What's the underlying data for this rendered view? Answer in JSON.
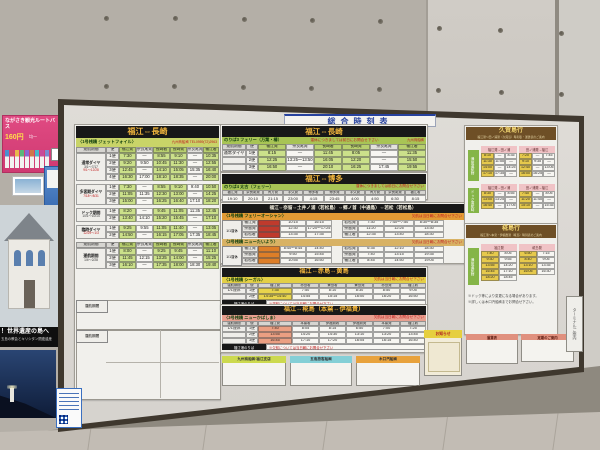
{
  "title_strip": "総合時刻表",
  "left_wall": {
    "bus_poster": {
      "title": "ながさき観光ルートバス",
      "price": "160円",
      "note": "均一"
    },
    "heritage_poster": {
      "band": "！世界遺産の島へ",
      "sub": "五島の教会とキリシタン関連遺産"
    }
  },
  "wall_sign": "ターミナルご案内",
  "jetfoil": {
    "route": "福江⇔長崎",
    "pier": "〈1号桟橋 ジェットフォイル〉",
    "contact": "九州商船㈱ TEL0959(72)2963",
    "col_headers": [
      "運航期間",
      "便",
      "福江発",
      "奈良尾発",
      "長崎着",
      "長崎発",
      "奈良尾発",
      "福江着"
    ],
    "sections": [
      {
        "period": "通常ダイヤ",
        "note": "3/1～7/17",
        "note_red": "9/1～12/28",
        "rows": [
          [
            "1便",
            "7:30",
            "—",
            "8:55",
            "9:10",
            "—",
            "10:35"
          ],
          [
            "2便",
            "9:20",
            "9:50",
            "10:45",
            "11:30",
            "—",
            "12:55"
          ],
          [
            "3便",
            "12:45",
            "—",
            "14:10",
            "15:05",
            "15:35",
            "16:40"
          ],
          [
            "4便",
            "16:30",
            "17:00",
            "18:10",
            "18:35",
            "—",
            "20:00"
          ]
        ]
      },
      {
        "period": "多客期ダイヤ",
        "note": "",
        "note_red": "7/18～8/31",
        "rows": [
          [
            "1便",
            "7:30",
            "—",
            "8:55",
            "9:10",
            "9:40",
            "10:50"
          ],
          [
            "2便",
            "11:05",
            "11:35",
            "12:30",
            "13:00",
            "—",
            "14:25"
          ],
          [
            "3便",
            "15:00",
            "—",
            "16:25",
            "16:40",
            "17:10",
            "18:20"
          ]
        ]
      },
      {
        "period": "ドック期間",
        "note": "10/1～10/14",
        "note_red": "",
        "rows": [
          [
            "1便",
            "8:20",
            "—",
            "9:45",
            "11:05",
            "11:35",
            "12:45"
          ],
          [
            "2便",
            "13:40",
            "14:10",
            "15:20",
            "15:45",
            "—",
            "17:10"
          ]
        ]
      },
      {
        "period": "臨時ダイヤ",
        "note": "",
        "note_red": "12/29～1/3",
        "rows": [
          [
            "1便",
            "9:25",
            "9:55",
            "11:05",
            "11:40",
            "—",
            "13:05"
          ],
          [
            "2便",
            "14:50",
            "—",
            "16:15",
            "17:05",
            "17:35",
            "18:45"
          ]
        ]
      },
      {
        "period": "運航期間",
        "note": "1/4～2/28",
        "note_red": "",
        "repeat_header": true,
        "rows": [
          [
            "1便",
            "8:00",
            "—",
            "9:25",
            "9:45",
            "—",
            "11:10"
          ],
          [
            "2便",
            "11:45",
            "12:15",
            "13:25",
            "14:00",
            "—",
            "15:25"
          ],
          [
            "3便",
            "16:10",
            "—",
            "17:35",
            "18:00",
            "18:30",
            "19:40"
          ]
        ]
      }
    ],
    "blank_labels": [
      "運航期間",
      "運航期間"
    ]
  },
  "ferry_nagasaki": {
    "route": "福江⇔長崎",
    "pier": "のりば3 フェリー（万葉・椿）",
    "warning": "運休につきましては前日にお問合せ下さい",
    "contact": "九州商船㈱",
    "col_headers": [
      "運航期間",
      "便",
      "福江発",
      "奈良尾発",
      "長崎着",
      "長崎発",
      "奈良尾発",
      "福江着"
    ],
    "rows": [
      [
        "通常ダイヤ",
        "1便",
        "8:15",
        "—",
        "11:45",
        "8:05",
        "—",
        "11:35"
      ],
      [
        "",
        "2便",
        "12:25",
        "13:25～13:50",
        "16:05",
        "12:20",
        "—",
        "15:50"
      ],
      [
        "",
        "3便",
        "16:50",
        "—",
        "20:10",
        "16:25",
        "17:45",
        "19:55"
      ]
    ]
  },
  "ferry_hakata": {
    "route": "福江⇔博多",
    "pier": "のりば4 太古（フェリー）",
    "warning": "運休につきましては前日にお問合せ下さい",
    "col_headers": [
      "福江発",
      "奈良尾発",
      "青方発",
      "宇久発",
      "博多着",
      "博多発",
      "宇久発",
      "青方発",
      "奈良尾発",
      "福江着"
    ],
    "rows": [
      [
        "19:10",
        "20:10",
        "21:15",
        "23:00",
        "4:15",
        "23:45",
        "4:00",
        "4:50",
        "6:30",
        "8:15"
      ]
    ]
  },
  "kamigoto": {
    "route": "福江⇔奈留⇔土井ノ浦（若松島）⇔郷ノ首（中通島）⇔若松（若松島）",
    "blocks": [
      {
        "pier": "〈1号桟橋 フェリーオーシャン〉",
        "warning": "欠航は当日朝にお問合せ下さい",
        "label": "1/1運休",
        "left_rows": [
          [
            "福江発",
            "",
            "10:15",
            "16:15"
          ],
          [
            "奈留発",
            "",
            "12:30",
            "17:20～17:25"
          ],
          [
            "若松着",
            "",
            "13:35",
            "17:35"
          ]
        ],
        "right_rows": [
          [
            "若松発",
            "7:30",
            "7:40～7:50",
            "8:30～8:35"
          ],
          [
            "奈留発",
            "11:20",
            "12:25",
            "13:30"
          ],
          [
            "福江着",
            "12:35",
            "13:40",
            "18:30"
          ]
        ]
      },
      {
        "pier": "〈2号桟橋 ニューたいよう〉",
        "warning": "欠航は当日朝にお問合せ下さい",
        "label": "1/1運休",
        "left_rows": [
          [
            "福江発",
            "",
            "8:40～8:45",
            "14:40"
          ],
          [
            "奈留発",
            "",
            "9:50",
            "15:45"
          ],
          [
            "若松着",
            "",
            "10:55",
            "16:50"
          ]
        ],
        "right_rows": [
          [
            "若松発",
            "6:35",
            "12:10",
            "18:30"
          ],
          [
            "奈留発",
            "7:40",
            "13:15",
            "19:35"
          ],
          [
            "福江着",
            "8:45",
            "14:50",
            "19:05"
          ]
        ]
      }
    ]
  },
  "akishima": {
    "route": "福江⇔赤島⇔黄島",
    "pier": "〈1号桟橋 シーガル〉",
    "warning": "欠航は当日朝にお問合せ下さい",
    "col_headers": [
      "運航期間",
      "便",
      "福江発",
      "赤島着",
      "黄島着",
      "黄島発",
      "赤島発",
      "福江着"
    ],
    "rows": [
      [
        "1/1運休",
        "1便",
        "7:35",
        "7:50",
        "8:10",
        "8:30",
        "8:50",
        "9:05"
      ],
      [
        "",
        "2便",
        "14:35～14:40",
        "14:55",
        "15:15",
        "16:00",
        "16:20",
        "16:50"
      ]
    ],
    "foot_label": "福江港のりば",
    "foot_note": "※運航については当日朝にお問合せ下さい"
  },
  "kabashima": {
    "route": "福江⇔椛島（本窯⇔伊福貴）",
    "pier": "〈3号桟橋 ニューかばしま〉",
    "warning": "欠航は当日朝にお問合せ下さい",
    "col_headers": [
      "運航期間",
      "便",
      "福江発",
      "本窯着",
      "伊福貴着",
      "伊福貴発",
      "本窯発",
      "福江着"
    ],
    "rows": [
      [
        "1/1運休",
        "1便",
        "7:40",
        "8:05",
        "8:15",
        "6:50",
        "7:00",
        "7:25"
      ],
      [
        "",
        "2便",
        "13:55",
        "14:20",
        "14:30",
        "13:10",
        "13:20",
        "13:45"
      ],
      [
        "",
        "3便",
        "16:45",
        "17:10",
        "17:20",
        "16:05",
        "16:15",
        "16:40"
      ]
    ],
    "foot_label": "福江港のりば",
    "foot_note": "※欠航については当日朝にお問合せ下さい"
  },
  "companies": [
    {
      "name": "九州商船㈱ 福江支店",
      "color": "#ccd94e"
    },
    {
      "name": "五島旅客船㈱",
      "color": "#84cfd6"
    },
    {
      "name": "木口汽船㈱",
      "color": "#e8a23c"
    }
  ],
  "notice_box": {
    "title": "お知らせ"
  },
  "hisaka": {
    "title": "久賀島行",
    "subtitle": "福江港～田ノ浦港（久賀島）時刻表・運賃表のご案内",
    "groups": [
      {
        "vlabel": "通常運航時",
        "tables": [
          {
            "header": "福江発→田ノ浦",
            "rows": [
              [
                "8:10",
                "—",
                "8:35"
              ],
              [
                "11:30",
                "11:55",
                "—"
              ],
              [
                "14:00",
                "—",
                "14:25"
              ],
              [
                "17:10",
                "17:35",
                "—"
              ]
            ]
          },
          {
            "header": "田ノ浦発→福江",
            "rows": [
              [
                "7:20",
                "—",
                "7:45"
              ],
              [
                "9:10",
                "9:35",
                "—"
              ],
              [
                "12:40",
                "—",
                "13:05"
              ],
              [
                "16:00",
                "16:25",
                "—"
              ]
            ]
          }
        ]
      },
      {
        "vlabel": "ドック運航時",
        "tables": [
          {
            "header": "福江発→田ノ浦",
            "rows": [
              [
                "8:30",
                "—",
                "8:55"
              ],
              [
                "13:00",
                "13:25",
                "—"
              ],
              [
                "16:40",
                "—",
                "17:05"
              ]
            ]
          },
          {
            "header": "田ノ浦発→福江",
            "rows": [
              [
                "7:40",
                "—",
                "8:05"
              ],
              [
                "11:20",
                "11:45",
                "—"
              ],
              [
                "15:10",
                "—",
                "15:35"
              ]
            ]
          }
        ]
      }
    ]
  },
  "kaba_right": {
    "title": "椛島行",
    "subtitle": "福江港～本窯・伊福貴港（椛島）時刻表のご案内",
    "groups": [
      {
        "vlabel": "通常運航時",
        "tables": [
          {
            "header": "福江発",
            "rows": [
              [
                "7:40",
                "8:05"
              ],
              [
                "9:30",
                "9:55"
              ],
              [
                "13:55",
                "14:20"
              ],
              [
                "16:45",
                "17:10"
              ],
              [
                "18:20",
                "18:45"
              ]
            ]
          },
          {
            "header": "椛島発",
            "rows": [
              [
                "6:50",
                "7:15"
              ],
              [
                "8:40",
                "9:05"
              ],
              [
                "13:10",
                "13:35"
              ],
              [
                "16:05",
                "16:30"
              ]
            ]
          }
        ]
      }
    ],
    "notes": [
      "※ドック等により変更になる場合があります。",
      "※詳しくは木口汽船㈱までお問合せ下さい。"
    ]
  },
  "right_boxes": [
    {
      "title": "運賃表"
    },
    {
      "title": "定期のご案内"
    }
  ]
}
